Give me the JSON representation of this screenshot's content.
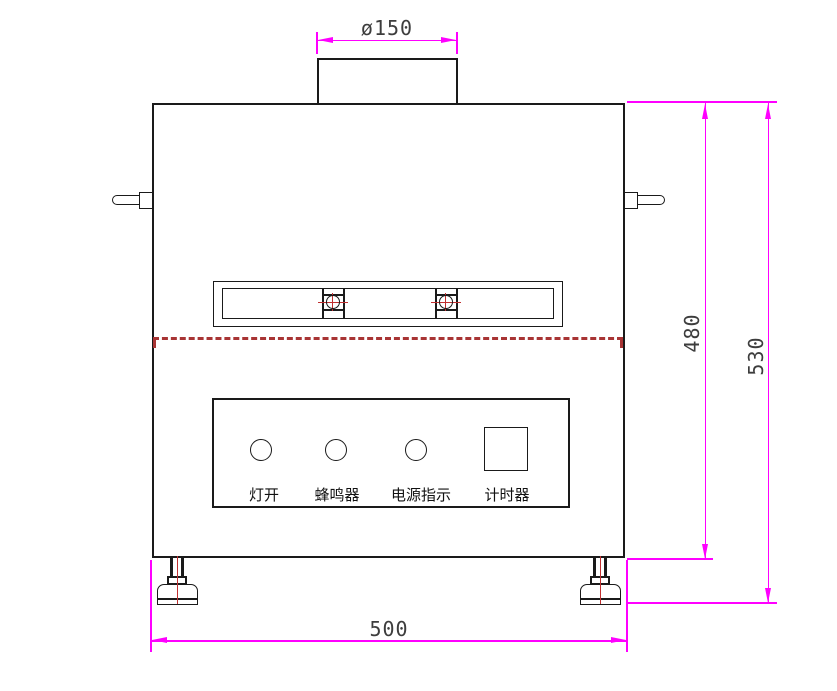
{
  "dimensions": {
    "duct_diameter": "ø150",
    "body_height": "480",
    "overall_height": "530",
    "body_width": "500"
  },
  "control_panel": {
    "light_on_label": "灯开",
    "buzzer_label": "蜂鸣器",
    "power_indicator_label": "电源指示",
    "timer_label": "计时器"
  },
  "colors": {
    "dimension_line": "#FF00FF",
    "dashed_parting_line": "#A83434",
    "red_center_line": "#C03030",
    "outline": "#1A1A1A"
  }
}
